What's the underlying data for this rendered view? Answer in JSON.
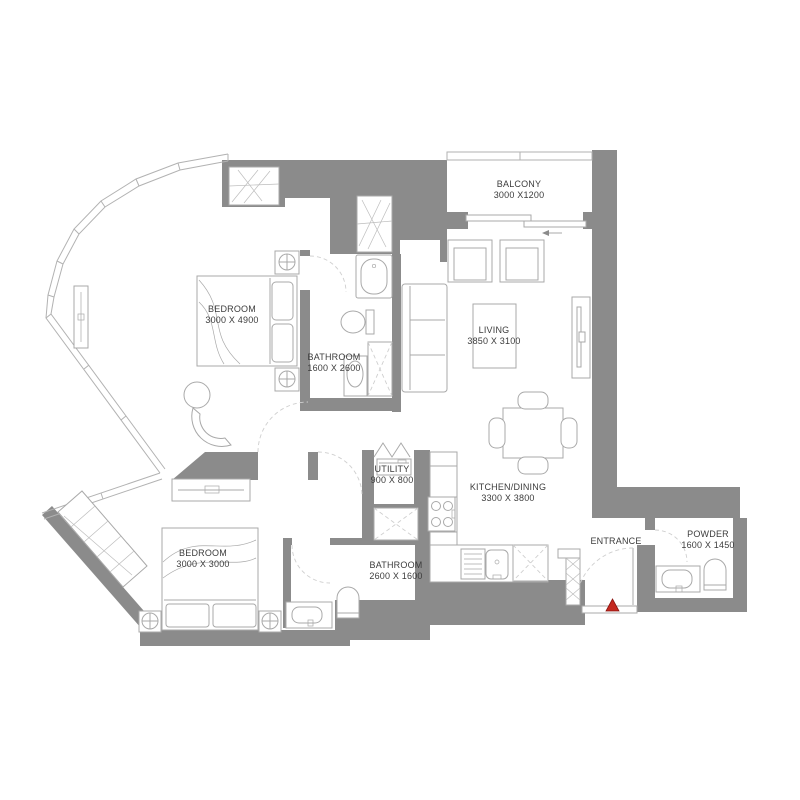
{
  "plan": {
    "type": "apartment-floor-plan",
    "rooms": [
      {
        "id": "balcony",
        "label": "BALCONY",
        "dims": "3000 X1200"
      },
      {
        "id": "bedroom-1",
        "label": "BEDROOM",
        "dims": "3000 X 4900"
      },
      {
        "id": "bathroom-1",
        "label": "BATHROOM",
        "dims": "1600 X 2600"
      },
      {
        "id": "living",
        "label": "LIVING",
        "dims": "3850 X 3100"
      },
      {
        "id": "kitchen-dining",
        "label": "KITCHEN/DINING",
        "dims": "3300 X 3800"
      },
      {
        "id": "utility",
        "label": "UTILITY",
        "dims": "900 X 800"
      },
      {
        "id": "bedroom-2",
        "label": "BEDROOM",
        "dims": "3000 X 3000"
      },
      {
        "id": "bathroom-2",
        "label": "BATHROOM",
        "dims": "2600 X 1600"
      },
      {
        "id": "entrance",
        "label": "ENTRANCE",
        "dims": ""
      },
      {
        "id": "powder",
        "label": "POWDER",
        "dims": "1600 X 1450"
      }
    ],
    "furniture_icons": [
      "bed",
      "wardrobe",
      "nightstand-lamp",
      "dresser",
      "bathtub",
      "toilet",
      "shower",
      "sink-vanity",
      "washing-machine",
      "stove",
      "kitchen-sink",
      "dining-table",
      "dining-chair",
      "sofa",
      "armchair",
      "coffee-table",
      "tv-unit",
      "duct-shaft",
      "stool",
      "desk"
    ],
    "entry_marker": {
      "symbol": "triangle-up",
      "color": "#c4281f"
    },
    "colors": {
      "wall": "#8b8b8b",
      "furniture_line": "#a9a9a9",
      "glass_line": "#b2b2b2",
      "text": "#3c3c3c",
      "entry_marker": "#c4281f",
      "background": "#ffffff"
    }
  }
}
